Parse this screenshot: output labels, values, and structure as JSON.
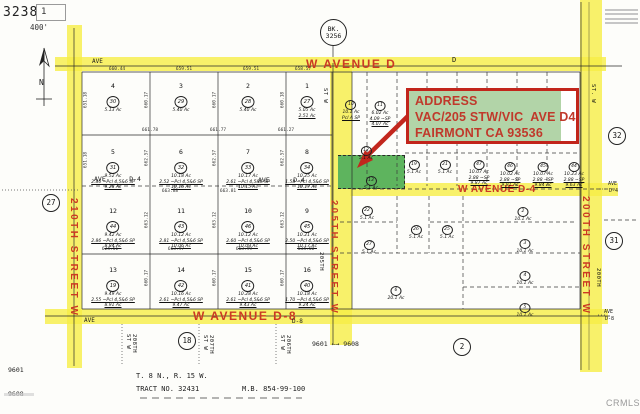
{
  "title_block": {
    "sheet": "3238",
    "inset": "1",
    "scale": "400'"
  },
  "compass_label": "N",
  "book_circle": {
    "line1": "BK.",
    "line2": "3256"
  },
  "address_box": {
    "lines": [
      "ADDRESS",
      "VAC/205 STW/VIC  AVE D4",
      "FAIRMONT CA 93536"
    ]
  },
  "roads": {
    "avenue_d": {
      "label": "W AVENUE D",
      "ave_small": "AVE",
      "d_small": "D"
    },
    "avenue_d4": {
      "label": "W AVENUE D-4",
      "left_small_1": "AVE      D-4",
      "left_small_2": "AVE      D-4",
      "right_small_1": "AVE",
      "right_small_2": "D-4"
    },
    "avenue_d8": {
      "label": "W AVENUE D-8",
      "ave_small": "AVE",
      "d8_small": "D-8",
      "right_small_1": "AVE",
      "right_small_2": "D-8"
    },
    "street_210": "210TH STREET W",
    "street_205": "205TH STREET W",
    "street_200": "200TH STREET W"
  },
  "ref_circles": [
    {
      "n": "27",
      "x": 51,
      "y": 203
    },
    {
      "n": "32",
      "x": 617,
      "y": 136
    },
    {
      "n": "31",
      "x": 614,
      "y": 241
    },
    {
      "n": "18",
      "x": 187,
      "y": 341
    },
    {
      "n": "2",
      "x": 462,
      "y": 347
    }
  ],
  "parcels_left": [
    {
      "num": "4",
      "circ": "30",
      "lines": [
        "5.13 Ac"
      ],
      "x": 113,
      "y": 82
    },
    {
      "num": "3",
      "circ": "29",
      "lines": [
        "5.40 Ac"
      ],
      "x": 181,
      "y": 82
    },
    {
      "num": "2",
      "circ": "28",
      "lines": [
        "5.40 Ac"
      ],
      "x": 248,
      "y": 82
    },
    {
      "num": "1",
      "circ": "27",
      "lines": [
        "5.05 Ac",
        "2.51 Ac"
      ],
      "x": 307,
      "y": 82
    },
    {
      "num": "5",
      "circ": "31",
      "lines": [
        "9.52 Ac",
        "2.86 ~Pcl 4,5&6 SP",
        "9.28 Ac"
      ],
      "x": 113,
      "y": 148
    },
    {
      "num": "6",
      "circ": "32",
      "lines": [
        "10.18 Ac",
        "2.52 ~Pcl 4,5&6 SP",
        "10.16 Ac"
      ],
      "x": 181,
      "y": 148
    },
    {
      "num": "7",
      "circ": "33",
      "lines": [
        "10.17 Ac",
        "2.61 ~Pcl 4,5&6 SP",
        "10.15 Ac"
      ],
      "x": 248,
      "y": 148
    },
    {
      "num": "8",
      "circ": "34",
      "lines": [
        "10.25 Ac",
        "1.58 ~Pcl 4,5&6 SP",
        "10.17 Ac"
      ],
      "x": 307,
      "y": 148
    },
    {
      "num": "12",
      "circ": "44",
      "lines": [
        "9.42 Ac",
        "2.86 ~Pcl 4,5&6 SP",
        "8.84 Ac"
      ],
      "x": 113,
      "y": 207
    },
    {
      "num": "11",
      "circ": "43",
      "lines": [
        "10.12 Ac",
        "2.81 ~Pcl 4,5&6 SP",
        "10.06 Ac"
      ],
      "x": 181,
      "y": 207
    },
    {
      "num": "10",
      "circ": "46",
      "lines": [
        "10.12 Ac",
        "2.60 ~Pcl 4,5&6 SP",
        "10.09 Ac"
      ],
      "x": 248,
      "y": 207
    },
    {
      "num": "9",
      "circ": "45",
      "lines": [
        "10.21 Ac",
        "2.50 ~Pcl 4,5&6 SP",
        "10.17 Ac"
      ],
      "x": 307,
      "y": 207
    },
    {
      "num": "13",
      "circ": "19",
      "lines": [
        "9.49 Ac",
        "2.55 ~Pcl 4,5&6 SP",
        "8.91 Ac"
      ],
      "x": 113,
      "y": 266
    },
    {
      "num": "14",
      "circ": "42",
      "lines": [
        "10.16 Ac",
        "2.61 ~Pcl 4,5&6 SP",
        "9.47 Ac"
      ],
      "x": 181,
      "y": 266
    },
    {
      "num": "15",
      "circ": "41",
      "lines": [
        "10.28 Ac",
        "2.61 ~Pcl 4,5&6 SP",
        "9.43 Ac"
      ],
      "x": 248,
      "y": 266
    },
    {
      "num": "16",
      "circ": "40",
      "lines": [
        "10.18 Ac",
        "1.70 ~Pcl 4,5&6 SP",
        "9.24 Ac"
      ],
      "x": 307,
      "y": 266
    }
  ],
  "parcels_right": [
    {
      "circ": "10",
      "lines": [
        "10.1 Ac",
        "Pcl A SP"
      ],
      "x": 351,
      "y": 92
    },
    {
      "circ": "11",
      "lines": [
        "6.02 Ac",
        "4.09 ~SP",
        "4.07 Ac"
      ],
      "x": 380,
      "y": 93
    },
    {
      "circ": "12",
      "lines": [
        "5.1 Ac"
      ],
      "x": 366,
      "y": 138
    },
    {
      "circ": "13",
      "lines": [
        "5.1 Ac"
      ],
      "x": 371,
      "y": 168
    },
    {
      "circ": "19",
      "lines": [
        "5.1 Ac"
      ],
      "x": 414,
      "y": 152
    },
    {
      "circ": "21",
      "lines": [
        "5.1 Ac"
      ],
      "x": 445,
      "y": 152
    },
    {
      "circ": "47",
      "lines": [
        "10.07 Ac",
        "2.88 ~SP",
        "9.87 Ac"
      ],
      "x": 479,
      "y": 152
    },
    {
      "circ": "46",
      "lines": [
        "10.02 Ac",
        "2.88 ~SP",
        "9.91 Ac"
      ],
      "x": 510,
      "y": 154
    },
    {
      "circ": "45",
      "lines": [
        "10.07 Ac",
        "2.88 ~SP",
        "9.84 Ac"
      ],
      "x": 543,
      "y": 154
    },
    {
      "circ": "44",
      "lines": [
        "10.23 Ac",
        "2.88 ~SP",
        "9.63 Ac"
      ],
      "x": 574,
      "y": 154
    },
    {
      "circ": "22",
      "lines": [
        "5.1 Ac"
      ],
      "x": 367,
      "y": 198
    },
    {
      "circ": "26",
      "lines": [
        "5.1 Ac"
      ],
      "x": 416,
      "y": 217
    },
    {
      "circ": "25",
      "lines": [
        "5.1 Ac"
      ],
      "x": 447,
      "y": 217
    },
    {
      "circ": "27",
      "lines": [
        "5.1 Ac"
      ],
      "x": 369,
      "y": 232
    },
    {
      "circ": "6",
      "lines": [
        "20.1 Ac"
      ],
      "x": 396,
      "y": 278
    },
    {
      "circ": "2",
      "lines": [
        "10.1 Ac"
      ],
      "x": 523,
      "y": 199
    },
    {
      "circ": "3",
      "lines": [
        "10.1 Ac"
      ],
      "x": 525,
      "y": 231
    },
    {
      "circ": "4",
      "lines": [
        "10.1 Ac"
      ],
      "x": 525,
      "y": 263
    },
    {
      "circ": "5",
      "lines": [
        "10.1 Ac"
      ],
      "x": 525,
      "y": 295
    }
  ],
  "dims": [
    {
      "t": "660.44",
      "x": 117,
      "y": 67
    },
    {
      "t": "659.51",
      "x": 184,
      "y": 67
    },
    {
      "t": "659.51",
      "x": 251,
      "y": 67
    },
    {
      "t": "658.57",
      "x": 303,
      "y": 67
    },
    {
      "t": "661.78",
      "x": 150,
      "y": 128
    },
    {
      "t": "661.77",
      "x": 218,
      "y": 128
    },
    {
      "t": "661.27",
      "x": 286,
      "y": 128
    },
    {
      "t": "663.88",
      "x": 170,
      "y": 189
    },
    {
      "t": "663.81",
      "x": 228,
      "y": 189
    },
    {
      "t": "624.51",
      "x": 110,
      "y": 247
    },
    {
      "t": "663.97",
      "x": 176,
      "y": 247
    },
    {
      "t": "663.99",
      "x": 244,
      "y": 247
    },
    {
      "t": "634.50",
      "x": 306,
      "y": 247
    },
    {
      "t": "651.18",
      "x": 86,
      "y": 100,
      "r": 1
    },
    {
      "t": "651.18",
      "x": 86,
      "y": 160,
      "r": 1
    },
    {
      "t": "660.17",
      "x": 147,
      "y": 100,
      "r": 1
    },
    {
      "t": "660.17",
      "x": 215,
      "y": 100,
      "r": 1
    },
    {
      "t": "660.18",
      "x": 283,
      "y": 100,
      "r": 1
    },
    {
      "t": "662.57",
      "x": 147,
      "y": 158,
      "r": 1
    },
    {
      "t": "662.57",
      "x": 215,
      "y": 158,
      "r": 1
    },
    {
      "t": "662.57",
      "x": 283,
      "y": 158,
      "r": 1
    },
    {
      "t": "663.12",
      "x": 147,
      "y": 220,
      "r": 1
    },
    {
      "t": "663.12",
      "x": 215,
      "y": 220,
      "r": 1
    },
    {
      "t": "663.12",
      "x": 283,
      "y": 220,
      "r": 1
    },
    {
      "t": "660.17",
      "x": 147,
      "y": 278,
      "r": 1
    },
    {
      "t": "660.17",
      "x": 215,
      "y": 278,
      "r": 1
    },
    {
      "t": "660.17",
      "x": 283,
      "y": 278,
      "r": 1
    }
  ],
  "sub_streets": [
    {
      "t": "208TH\nST W",
      "x": 125,
      "y": 334
    },
    {
      "t": "207TH\nST W",
      "x": 202,
      "y": 335
    },
    {
      "t": "206TH\nST W",
      "x": 279,
      "y": 335
    },
    {
      "t": "205TH",
      "x": 318,
      "y": 252
    },
    {
      "t": "200TH",
      "x": 595,
      "y": 268
    },
    {
      "t": "ST W",
      "x": 322,
      "y": 88
    },
    {
      "t": "ST. W",
      "x": 590,
      "y": 84
    }
  ],
  "markers": {
    "left_line1": "9601",
    "left_line2": "9608",
    "range": "9601 ←→ 9608"
  },
  "footer": {
    "township": "T. 8 N., R. 15 W.",
    "tract": "TRACT NO. 32431",
    "mb": "M.B. 854-99-100"
  },
  "watermark": "CRMLS",
  "colors": {
    "highlight": "#f6ee46",
    "subject_green": "#5eb45e",
    "callout_red": "#c2251b",
    "label_red": "#cb3a24"
  }
}
